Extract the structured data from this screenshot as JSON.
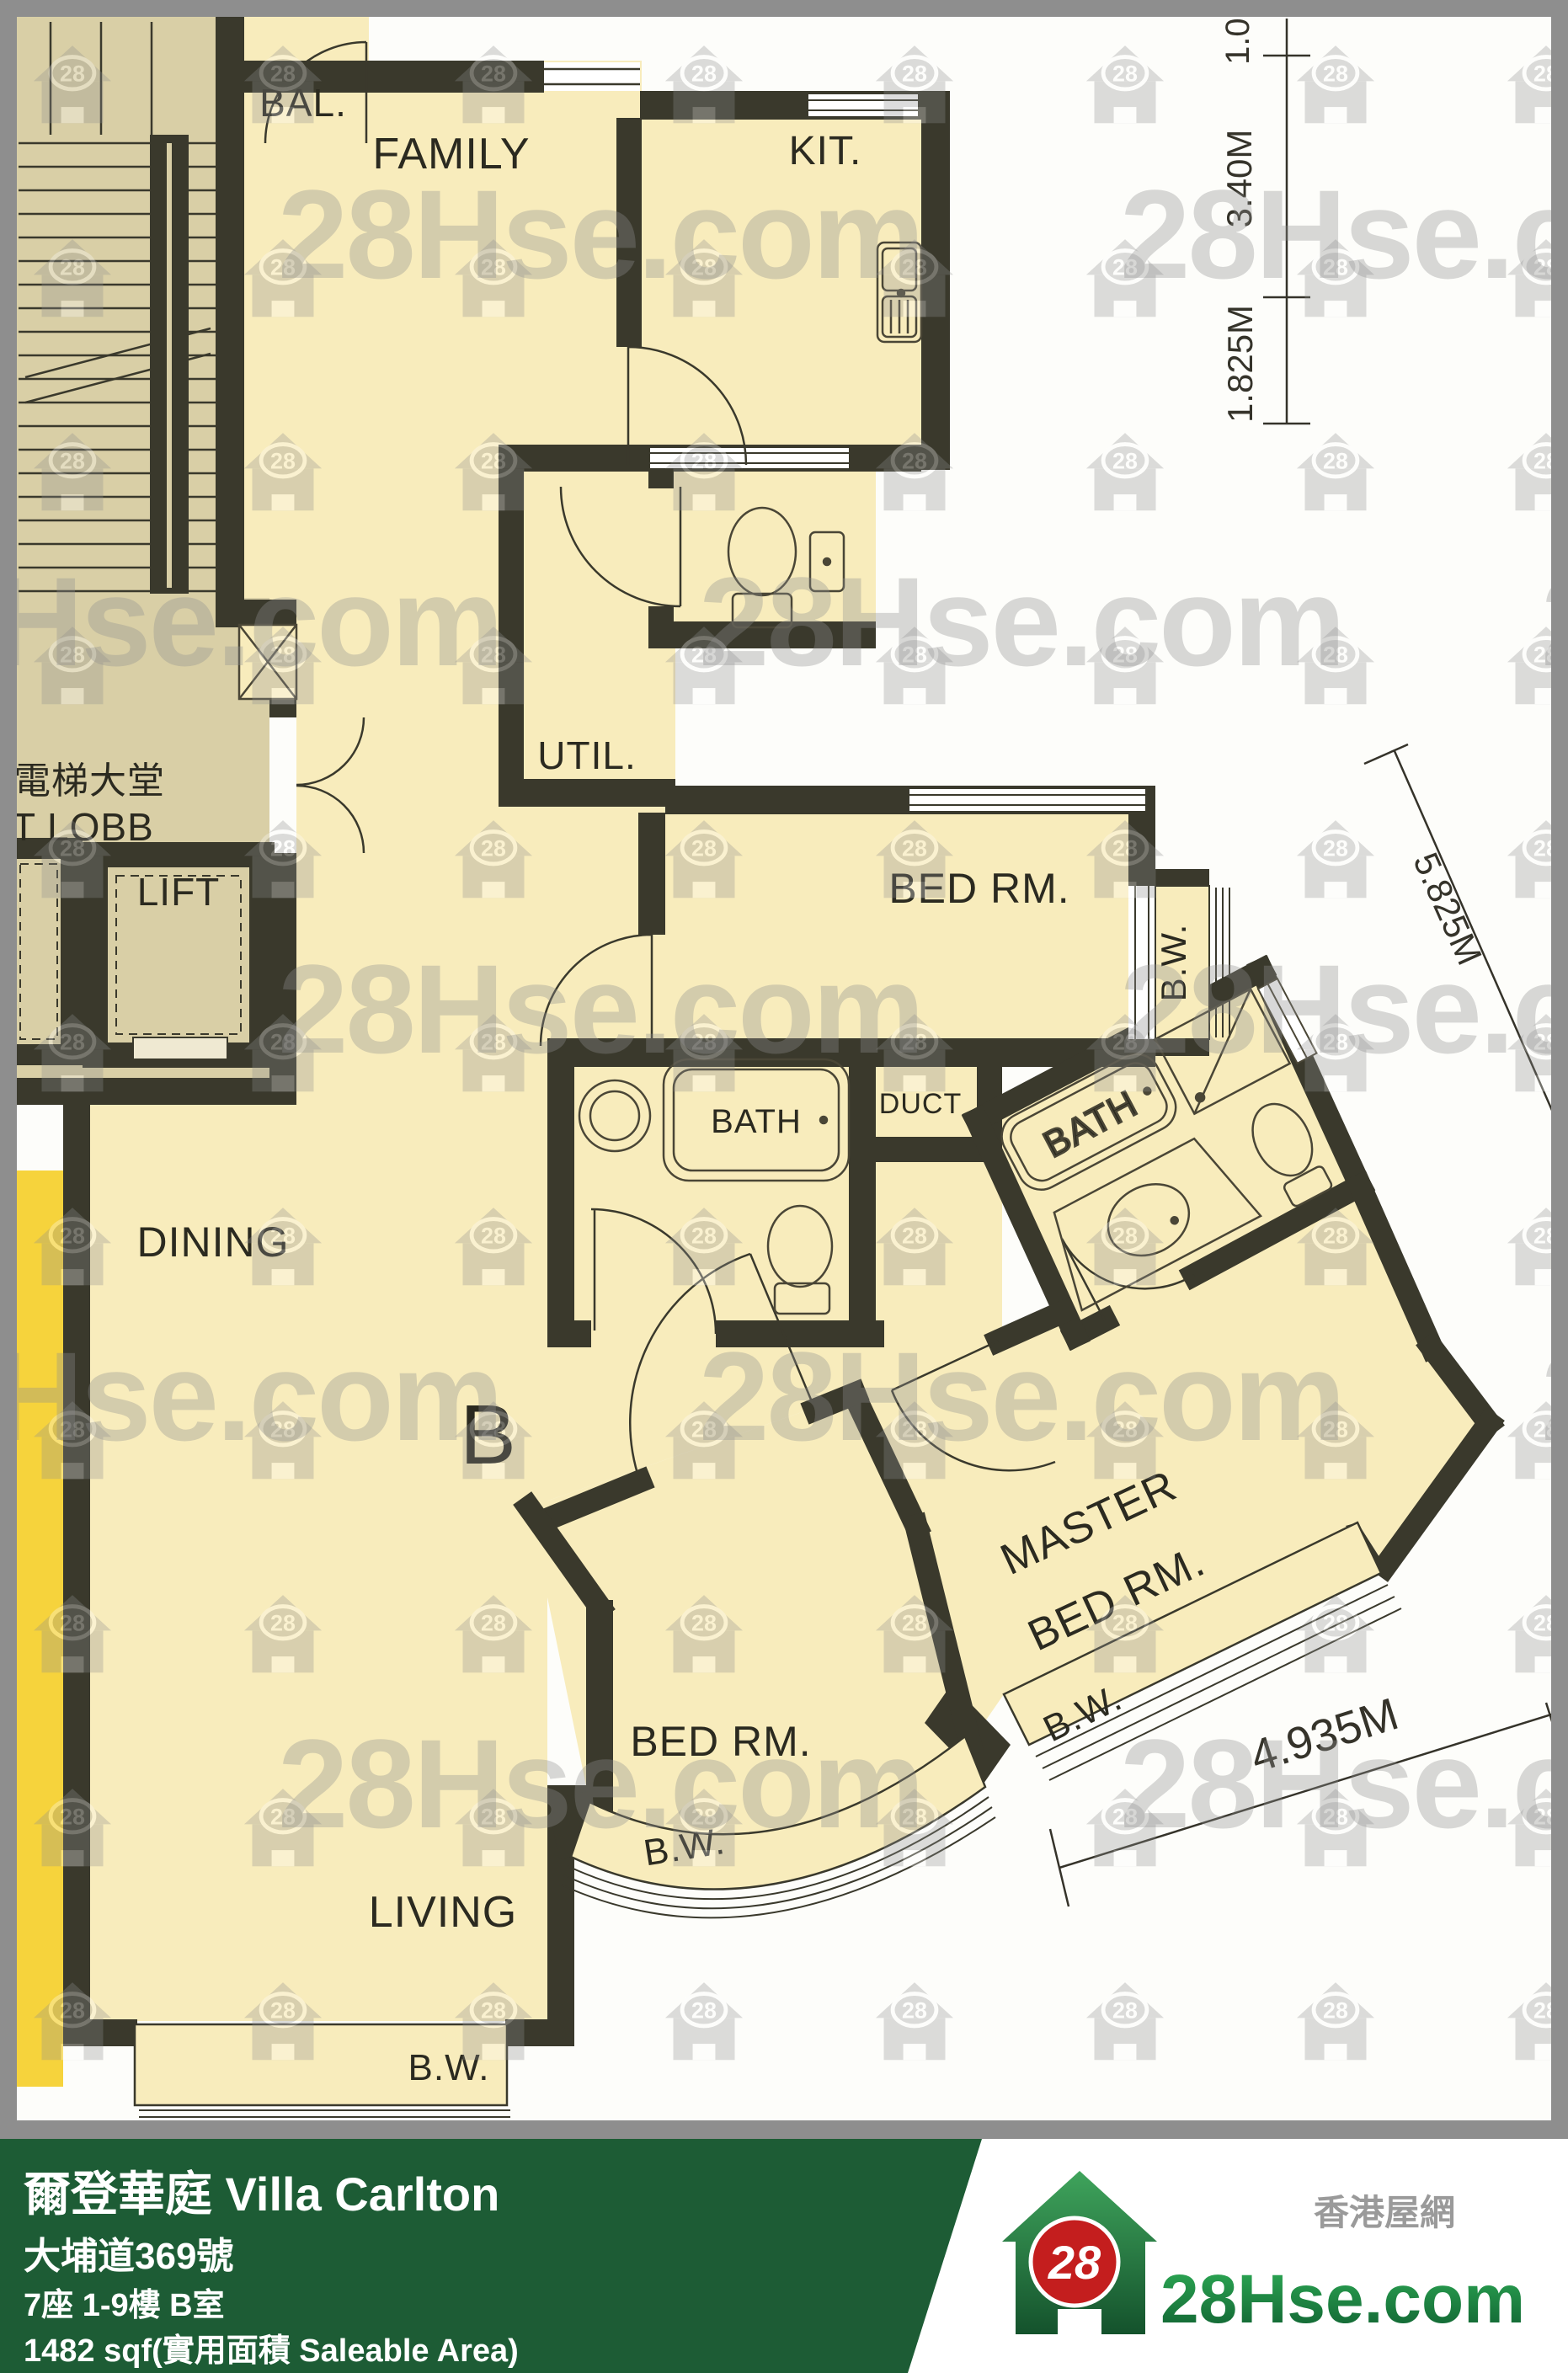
{
  "watermark": {
    "text": "28Hse.com",
    "icon_text": "28"
  },
  "plan": {
    "rooms": {
      "balcony": "BAL.",
      "family": "FAMILY",
      "kitchen": "KIT.",
      "utility": "UTIL.",
      "lobby_zh": "電梯大堂",
      "lobby_en": "T LOBB",
      "lift": "LIFT",
      "bedroom_mid": "BED RM.",
      "bath": "BATH",
      "duct": "DUCT",
      "master_bath": "BATH",
      "dining": "DINING",
      "unit": "B",
      "bedroom_bottom": "BED RM.",
      "master_line1": "MASTER",
      "master_line2": "BED RM.",
      "living": "LIVING"
    },
    "bay_window": {
      "mid": "B.W.",
      "bottom": "B.W.",
      "master": "B.W.",
      "living": "B.W."
    },
    "dimensions": {
      "top_right": "1.02",
      "right_upper": "3.40M",
      "right_lower": "1.825M",
      "diagonal": "5.825M",
      "bottom": "4.935M"
    }
  },
  "footer": {
    "building": "爾登華庭 Villa Carlton",
    "address": "大埔道369號",
    "unit": "7座 1-9樓 B室",
    "area": "1482 sqf(實用面積 Saleable Area)"
  },
  "logo": {
    "badge": "28",
    "brand": "28Hse.com",
    "site_zh": "香港屋網"
  },
  "colors": {
    "footer_green": "#1d5c35",
    "plan_cream": "#f8ecbc",
    "plan_beige": "#d9cfa6",
    "highlight_yellow": "#f6d33c",
    "wall_dark": "#3a392c",
    "logo_green": "#1e7a3f",
    "logo_red": "#c41e1e"
  }
}
